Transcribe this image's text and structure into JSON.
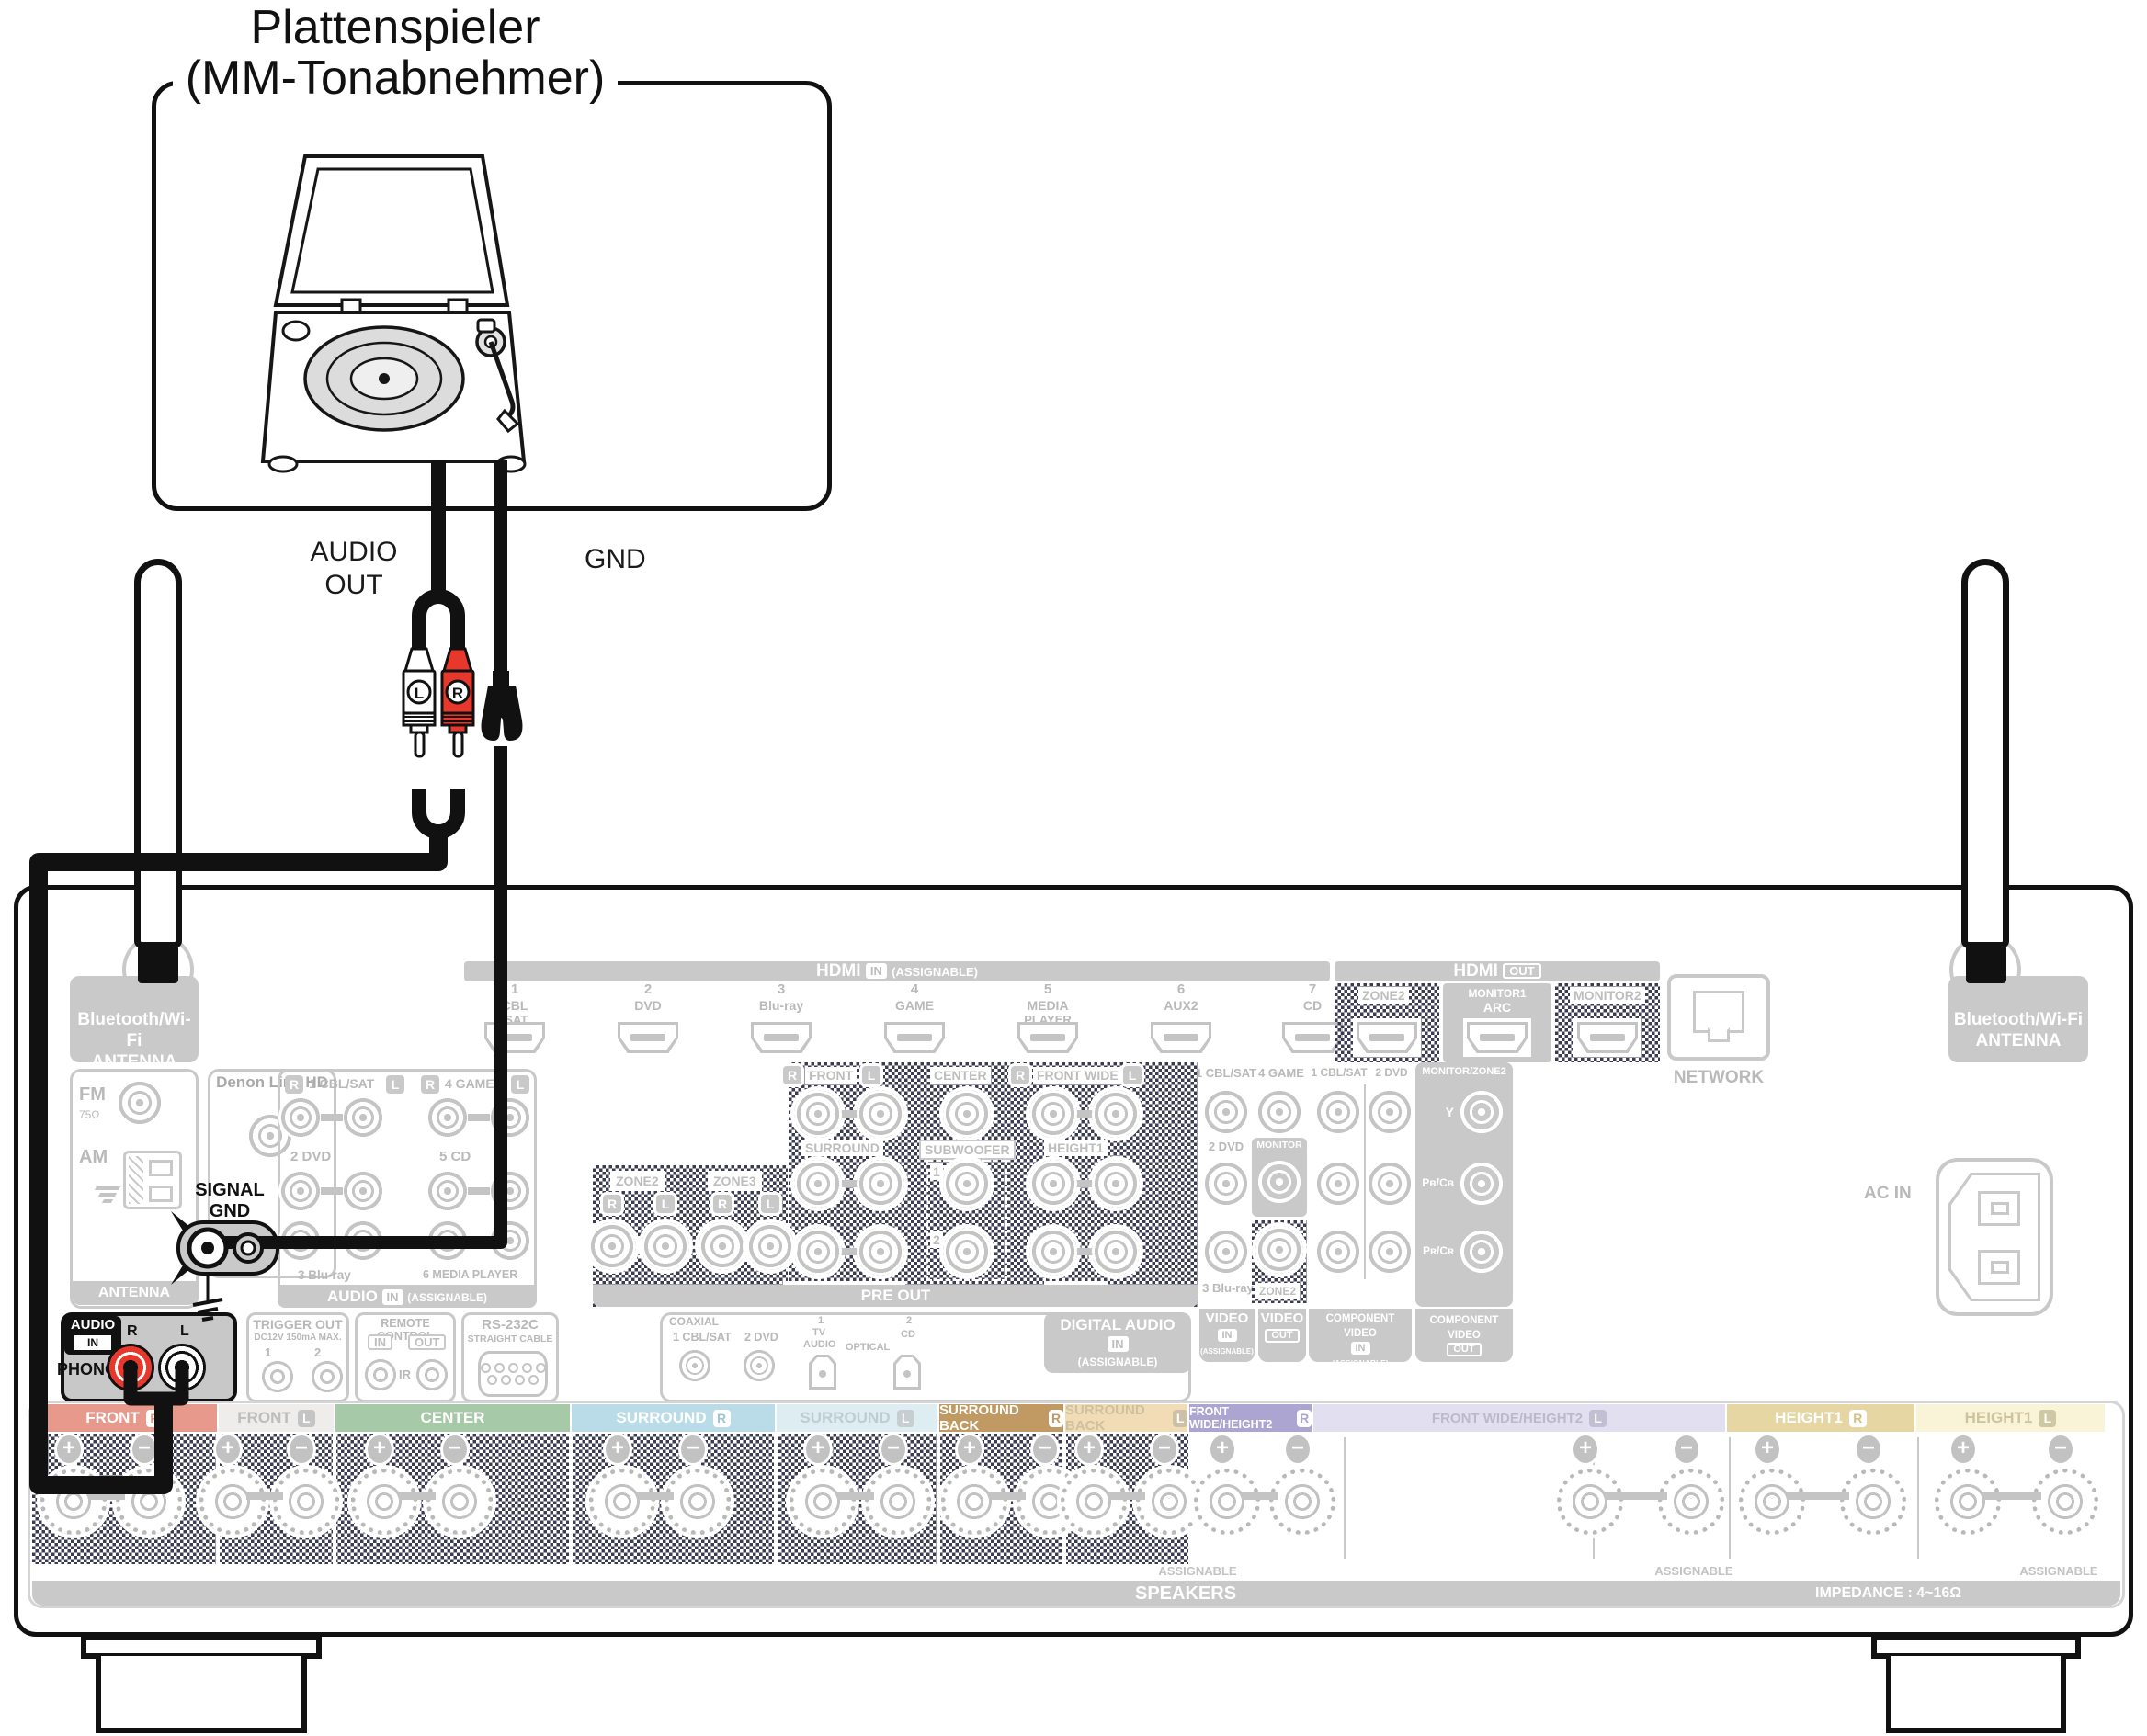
{
  "title": {
    "line1": "Plattenspieler",
    "line2": "(MM-Tonabnehmer)"
  },
  "cable_labels": {
    "audio_1": "AUDIO",
    "audio_2": "OUT",
    "gnd": "GND"
  },
  "plugs": {
    "l": "L",
    "r": "R"
  },
  "colors": {
    "cable": "#111111",
    "phono_red": "#e8382c",
    "faded_line": "#c4c4c4",
    "panel_gray": "#c9c9c9"
  },
  "receiver": {
    "hdmi_in": {
      "name": "HDMI",
      "badge": "IN",
      "assignable": "(ASSIGNABLE)",
      "ports": [
        {
          "n": "1",
          "l1": "CBL",
          "l2": "/SAT"
        },
        {
          "n": "2",
          "l1": "DVD",
          "l2": ""
        },
        {
          "n": "3",
          "l1": "Blu-ray",
          "l2": ""
        },
        {
          "n": "4",
          "l1": "GAME",
          "l2": ""
        },
        {
          "n": "5",
          "l1": "MEDIA",
          "l2": "PLAYER"
        },
        {
          "n": "6",
          "l1": "AUX2",
          "l2": ""
        },
        {
          "n": "7",
          "l1": "CD",
          "l2": ""
        }
      ]
    },
    "hdmi_out": {
      "name": "HDMI",
      "badge": "OUT",
      "zone2": "ZONE2",
      "monitor1": "MONITOR1",
      "arc": "ARC",
      "monitor2": "MONITOR2"
    },
    "network": "NETWORK",
    "bt_antenna": {
      "line1": "Bluetooth/Wi-Fi",
      "line2": "ANTENNA"
    },
    "tuner": {
      "fm": "FM",
      "ohm": "75Ω",
      "am": "AM",
      "bar": "ANTENNA"
    },
    "denon_link": "Denon Link HD",
    "signal_gnd": {
      "line1": "SIGNAL",
      "line2": "GND"
    },
    "audio_in": {
      "r": "R",
      "l": "L",
      "in1": "1 CBL/SAT",
      "in4": "4 GAME",
      "in2": "2 DVD",
      "in5": "5 CD",
      "in3": "3 Blu-ray",
      "in6": "6 MEDIA PLAYER",
      "bar": "AUDIO",
      "badge": "IN",
      "assignable": "(ASSIGNABLE)"
    },
    "phono": {
      "audio": "AUDIO",
      "badge": "IN",
      "label": "PHONO",
      "r": "R",
      "l": "L"
    },
    "trigger": {
      "title": "TRIGGER OUT",
      "sub": "DC12V 150mA MAX.",
      "n1": "1",
      "n2": "2"
    },
    "remote": {
      "title": "REMOTE CONTROL",
      "in": "IN",
      "out": "OUT",
      "ir": "IR"
    },
    "rs232": {
      "title": "RS-232C",
      "sub": "STRAIGHT CABLE"
    },
    "preout": {
      "zone2": "ZONE2",
      "zone3": "ZONE3",
      "r": "R",
      "l": "L",
      "front": "FRONT",
      "center": "CENTER",
      "front_wide": "FRONT WIDE",
      "surround": "SURROUND",
      "subwoofer": "SUBWOOFER",
      "height1": "HEIGHT1",
      "surround_back": "SURROUND BACK",
      "height2": "HEIGHT2",
      "n1": "1",
      "n2": "2",
      "bar": "PRE OUT"
    },
    "digital": {
      "coaxial": "COAXIAL",
      "in1": "1 CBL/SAT",
      "in2": "2 DVD",
      "opt_n": "1",
      "opt_l1": "TV",
      "opt_l2": "AUDIO",
      "optical": "OPTICAL",
      "cd_n": "2",
      "cd": "CD",
      "title": "DIGITAL AUDIO",
      "badge": "IN",
      "assignable": "(ASSIGNABLE)"
    },
    "video": {
      "in1": "1 CBL/SAT",
      "in2": "2 DVD",
      "in3": "3 Blu-ray",
      "game": "4 GAME",
      "monitor": "MONITOR",
      "zone2": "ZONE2",
      "video": "VIDEO",
      "badge_in": "IN",
      "badge_out": "OUT",
      "assignable": "(ASSIGNABLE)",
      "component": "COMPONENT VIDEO",
      "cin1": "1 CBL/SAT",
      "cin2": "2 DVD",
      "mz": "MONITOR/ZONE2",
      "y": "Y",
      "pb": "Pʙ/Cʙ",
      "pr": "Pʀ/Cʀ"
    },
    "ac_in": "AC IN",
    "speakers": {
      "assignable": "ASSIGNABLE",
      "bar": "SPEAKERS",
      "impedance": "IMPEDANCE : 4~16Ω",
      "channels": [
        {
          "label": "FRONT",
          "ch": "R",
          "bg": "#e79a8b",
          "fg": "#ffffff",
          "badge_bg": "#ffffff",
          "badge_fg": "#e79a8b"
        },
        {
          "label": "FRONT",
          "ch": "L",
          "bg": "#eeedeb",
          "fg": "#bcbcbc",
          "badge_bg": "#c4c4c4",
          "badge_fg": "#ffffff"
        },
        {
          "label": "CENTER",
          "ch": "",
          "bg": "#a6c9a8",
          "fg": "#ffffff",
          "badge_bg": "#ffffff",
          "badge_fg": "#a6c9a8"
        },
        {
          "label": "SURROUND",
          "ch": "R",
          "bg": "#badce8",
          "fg": "#ffffff",
          "badge_bg": "#ffffff",
          "badge_fg": "#9fc4d4"
        },
        {
          "label": "SURROUND",
          "ch": "L",
          "bg": "#ddedf2",
          "fg": "#becdd3",
          "badge_bg": "#c6ced2",
          "badge_fg": "#ffffff"
        },
        {
          "label": "SURROUND BACK",
          "ch": "R",
          "bg": "#c19a63",
          "fg": "#ffffff",
          "badge_bg": "#ffffff",
          "badge_fg": "#c19a63"
        },
        {
          "label": "SURROUND BACK",
          "ch": "L",
          "bg": "#f1dcb5",
          "fg": "#cfc0a0",
          "badge_bg": "#ccc0a8",
          "badge_fg": "#ffffff"
        },
        {
          "label": "FRONT WIDE/HEIGHT2",
          "ch": "R",
          "bg": "#ada5d1",
          "fg": "#ffffff",
          "badge_bg": "#ffffff",
          "badge_fg": "#ada5d1"
        },
        {
          "label": "FRONT WIDE/HEIGHT2",
          "ch": "L",
          "bg": "#e2dff0",
          "fg": "#bcb9cc",
          "badge_bg": "#c2bed4",
          "badge_fg": "#ffffff"
        },
        {
          "label": "HEIGHT1",
          "ch": "R",
          "bg": "#e5d6a3",
          "fg": "#ffffff",
          "badge_bg": "#ffffff",
          "badge_fg": "#d6c183"
        },
        {
          "label": "HEIGHT1",
          "ch": "L",
          "bg": "#f9f3d7",
          "fg": "#cdc49f",
          "badge_bg": "#cfc8a4",
          "badge_fg": "#ffffff"
        }
      ]
    }
  }
}
